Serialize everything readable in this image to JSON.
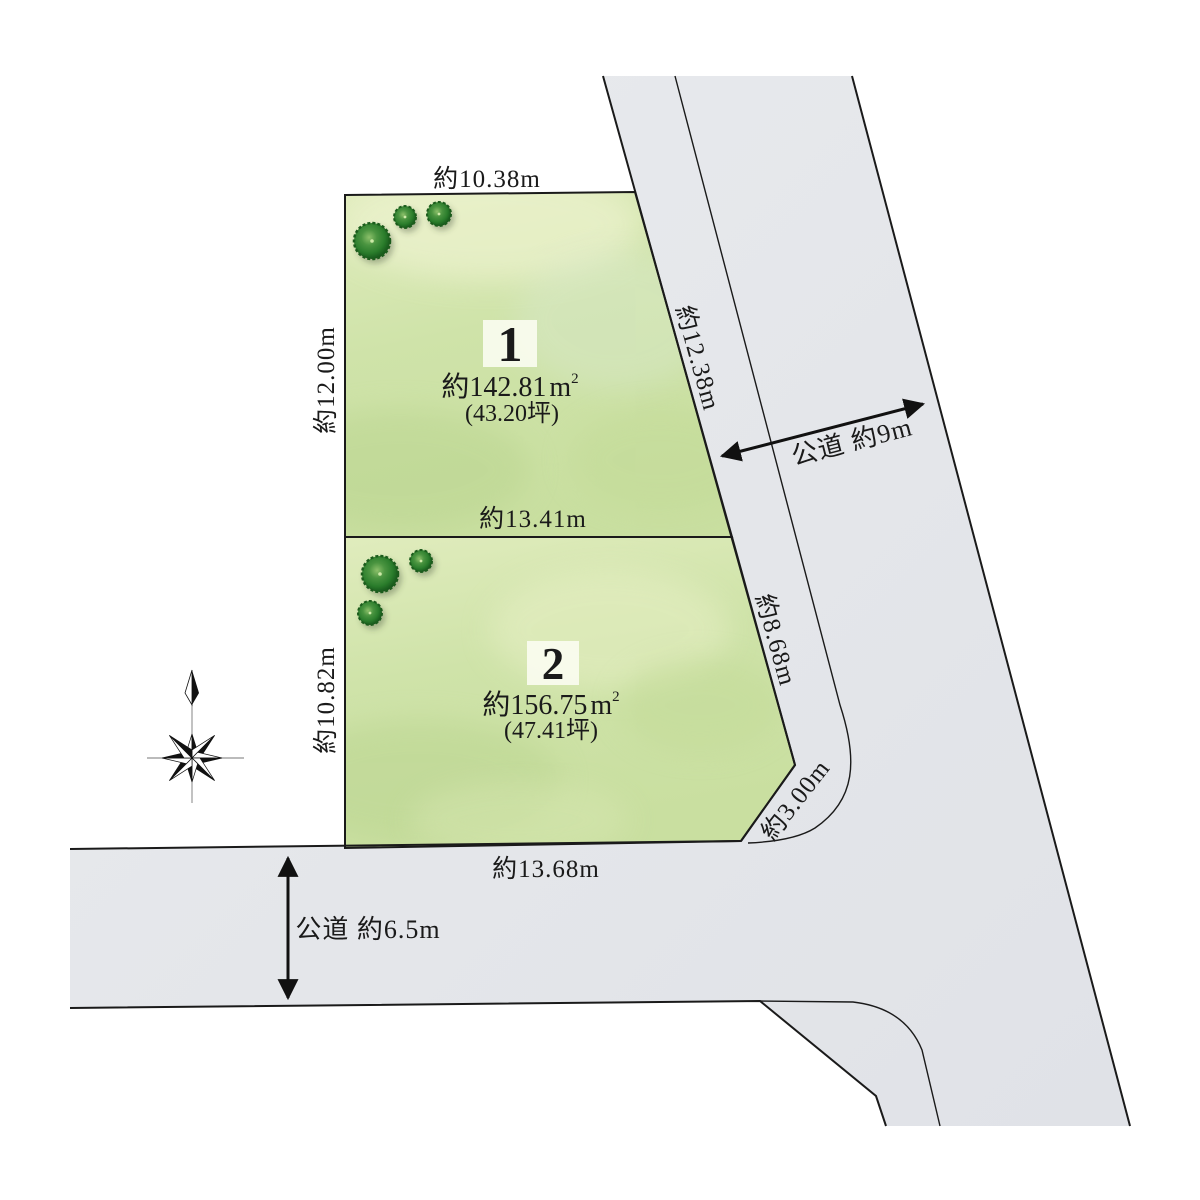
{
  "parcels": [
    {
      "number": "1",
      "area_value": "約142.81",
      "area_unit": "m",
      "area_sup": "2",
      "area_tsubo": "(43.20坪)",
      "dim_top": "約10.38m",
      "dim_left": "約12.00m",
      "dim_bottom": "約13.41m",
      "dim_right": "約12.38m"
    },
    {
      "number": "2",
      "area_value": "約156.75",
      "area_unit": "m",
      "area_sup": "2",
      "area_tsubo": "(47.41坪)",
      "dim_left": "約10.82m",
      "dim_bottom": "約13.68m",
      "dim_right": "約8.68m",
      "dim_corner": "約3.00m"
    }
  ],
  "roads": [
    {
      "label": "公道 約9m"
    },
    {
      "label": "公道 約6.5m"
    }
  ],
  "colors": {
    "line": "#1a1a1a",
    "parcel_green": "#cfe3a9",
    "parcel_green_light": "#e6efc8",
    "road_gray": "#e4e6ea",
    "road_gray_light": "#edeef2",
    "number_box": "#fcfdf3",
    "tree_dark": "#1d5c1e",
    "tree_mid": "#2f7d2a",
    "tree_light": "#8cc06a"
  }
}
